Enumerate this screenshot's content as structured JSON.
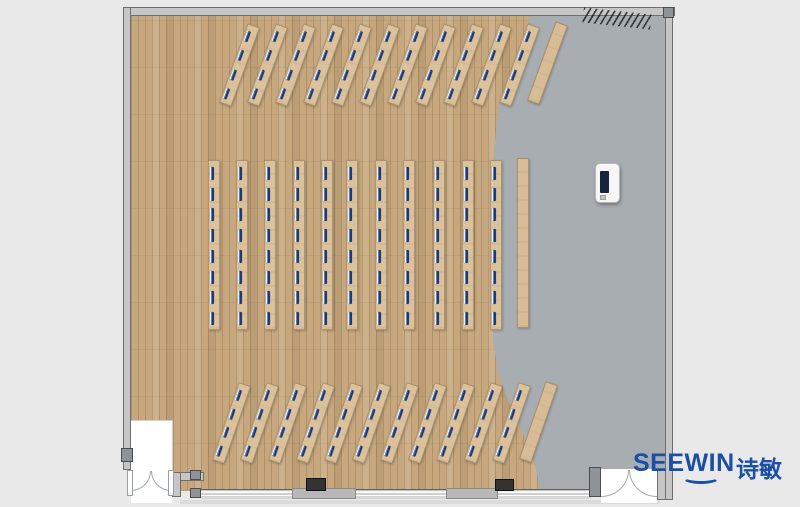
{
  "brand": {
    "name": "SEEWIN",
    "name_cn": "诗敏",
    "color": "#1b4fa6"
  },
  "palette": {
    "outside": "#e9e9e9",
    "wood_floor": "#c6a77e",
    "gray_floor": "#a8adb1",
    "desk": "#dcc29c",
    "seat_marker": "#1e3a70",
    "wall": "#c6c6c6",
    "structural_column": "#303030",
    "logo_blue": "#1b4fa6"
  },
  "floorplan": {
    "banks": [
      {
        "id": "top-angled-bank",
        "angle": 20,
        "desk_w": 13,
        "desk_h": 84,
        "mark_w": 4,
        "mark_h": 11,
        "center_y": 65,
        "centers_x": [
          239,
          267,
          295,
          323,
          351,
          379,
          407,
          435,
          463,
          491,
          519
        ],
        "seats_per_desk": 4,
        "plain_strip": {
          "cx": 547,
          "cy": 63
        }
      },
      {
        "id": "middle-straight-bank",
        "angle": 0,
        "desk_w": 12,
        "desk_h": 170,
        "mark_w": 4,
        "mark_h": 13,
        "center_y": 245,
        "centers_x": [
          214,
          242,
          270,
          299,
          327,
          352,
          381,
          409,
          439,
          468,
          496
        ],
        "seats_per_desk": 8,
        "plain_strip": {
          "cx": 523,
          "cy": 243
        }
      },
      {
        "id": "bottom-angled-bank",
        "angle": 19,
        "desk_w": 13,
        "desk_h": 82,
        "mark_w": 4,
        "mark_h": 11,
        "center_y": 423,
        "centers_x": [
          231,
          259,
          287,
          315,
          343,
          371,
          399,
          427,
          455,
          483,
          511
        ],
        "seats_per_desk": 4,
        "plain_strip": {
          "cx": 538,
          "cy": 422
        }
      }
    ],
    "structural_columns": [
      {
        "x": 306,
        "y": 478,
        "w": 20,
        "h": 13
      },
      {
        "x": 495,
        "y": 479,
        "w": 19,
        "h": 12
      }
    ],
    "display_device": {
      "x": 595,
      "y": 163,
      "w": 25,
      "h": 40
    },
    "hatch_mark": {
      "x": 583,
      "y": 11,
      "w": 68,
      "h": 15,
      "angle": 6
    }
  }
}
